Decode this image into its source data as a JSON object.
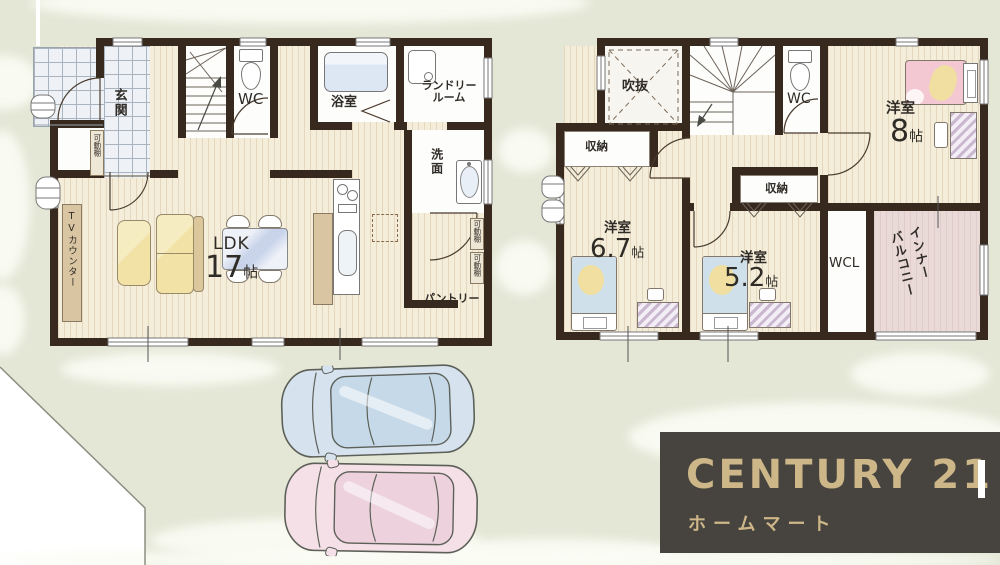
{
  "plan": {
    "floor1": {
      "entrance": "玄関",
      "wc": "WC",
      "bath": "浴室",
      "laundry_l1": "ランドリー",
      "laundry_l2": "ルーム",
      "washroom": "洗面",
      "ldk": "LDK",
      "ldk_size": "17",
      "ldk_unit": "帖",
      "tv_counter": "TVカウンター",
      "pantry": "パントリー",
      "movable_shelf": "可動棚"
    },
    "floor2": {
      "void": "吹抜",
      "wc": "WC",
      "storage": "収納",
      "room_label": "洋室",
      "room8_size": "8",
      "room67_size": "6.7",
      "room52_size": "5.2",
      "size_unit": "帖",
      "wcl": "WCL",
      "inner_balcony_l1": "インナー",
      "inner_balcony_l2": "バルコニー"
    }
  },
  "logo": {
    "brand": "CENTURY 21",
    "company": "ホームマート"
  },
  "colors": {
    "site": "#e4e6d6",
    "wall": "#38291e",
    "wood_floor": "#f4edda",
    "tile_floor": "#eef2f6",
    "logo_bg": "#474440",
    "logo_text": "#cdb687",
    "car_blue": "#d6e3ef",
    "car_pink": "#f5e0e8",
    "bed_pink": "#f3c8d2",
    "bed_blue": "#cfe0ea",
    "sofa_yellow": "#f2e2a6"
  }
}
